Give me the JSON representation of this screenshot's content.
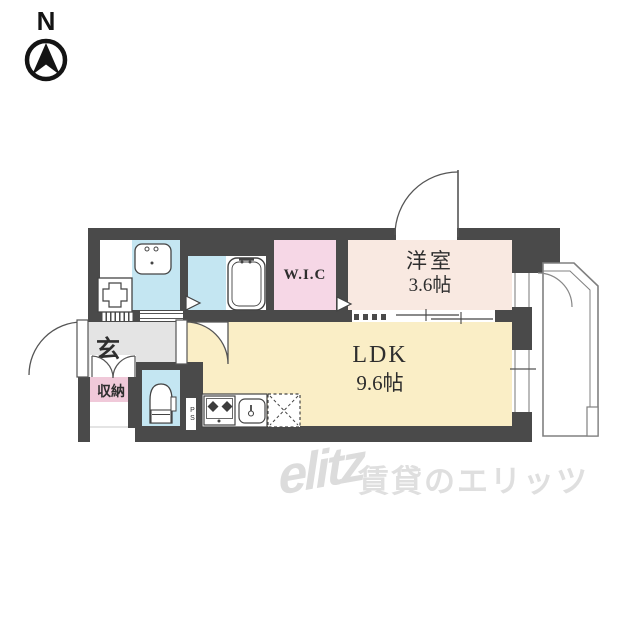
{
  "compass": {
    "label": "N"
  },
  "rooms": {
    "western": {
      "name": "洋室",
      "size": "3.6帖"
    },
    "ldk": {
      "name": "LDK",
      "size": "9.6帖"
    },
    "wic": {
      "name": "W.I.C"
    },
    "entrance": {
      "name": "玄"
    },
    "storage": {
      "name": "収納"
    },
    "balcony": {
      "name": "バルコニー"
    },
    "pipe_space": {
      "name": "PS"
    }
  },
  "watermark": {
    "logo": "elitz",
    "text": "賃貸のエリッツ"
  },
  "colors": {
    "wall": "#4a4a4a",
    "water_rooms": "#c4e6f2",
    "wic": "#f6d7e6",
    "western_room": "#f9e9e1",
    "ldk": "#faeec6",
    "hall": "#e4e4e4",
    "storage_label": "#f0c9d9",
    "watermark": "#dedede"
  }
}
